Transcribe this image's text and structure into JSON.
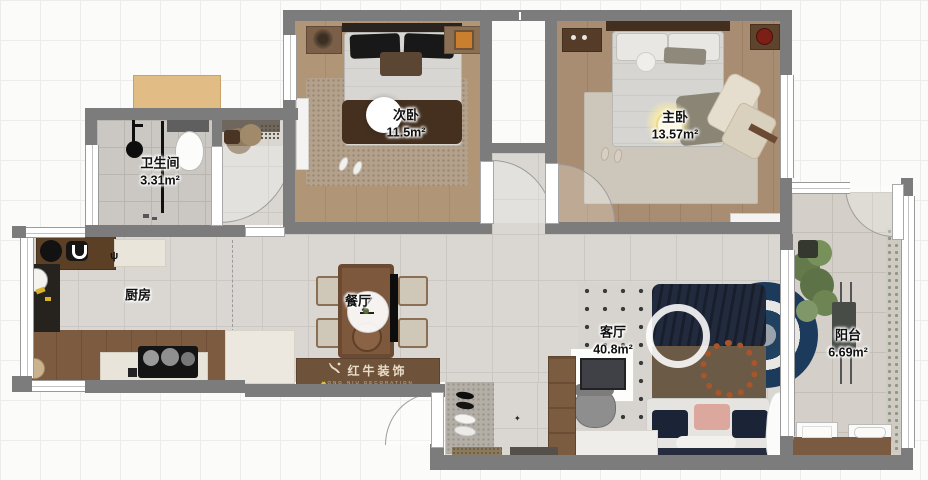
{
  "plan": {
    "rooms": [
      {
        "key": "secondary-bedroom",
        "label": "次卧",
        "area": "11.5m²"
      },
      {
        "key": "master-bedroom",
        "label": "主卧",
        "area": "13.57m²"
      },
      {
        "key": "bathroom",
        "label": "卫生间",
        "area": "3.31m²"
      },
      {
        "key": "kitchen",
        "label": "厨房",
        "area": ""
      },
      {
        "key": "dining-room",
        "label": "餐厅",
        "area": ""
      },
      {
        "key": "living-room",
        "label": "客厅",
        "area": "40.8m²"
      },
      {
        "key": "balcony",
        "label": "阳台",
        "area": "6.69m²"
      }
    ],
    "watermark": {
      "text": "红牛装饰",
      "subtext": "HONG NIU DECORATION"
    },
    "icons": {
      "kitchen_utensil": "ψ",
      "entry_star": "✦"
    },
    "colors": {
      "wall": "#7c7c7c",
      "tile_floor": "#dad7d2",
      "wood_floor": "#ab9078",
      "rug_navy": "#1c3a5c",
      "counter_dark": "#5c4026",
      "counter_cream": "#eae5da",
      "banner_brown": "#6f523a",
      "glow_yellow": "#f4e6a2"
    }
  }
}
